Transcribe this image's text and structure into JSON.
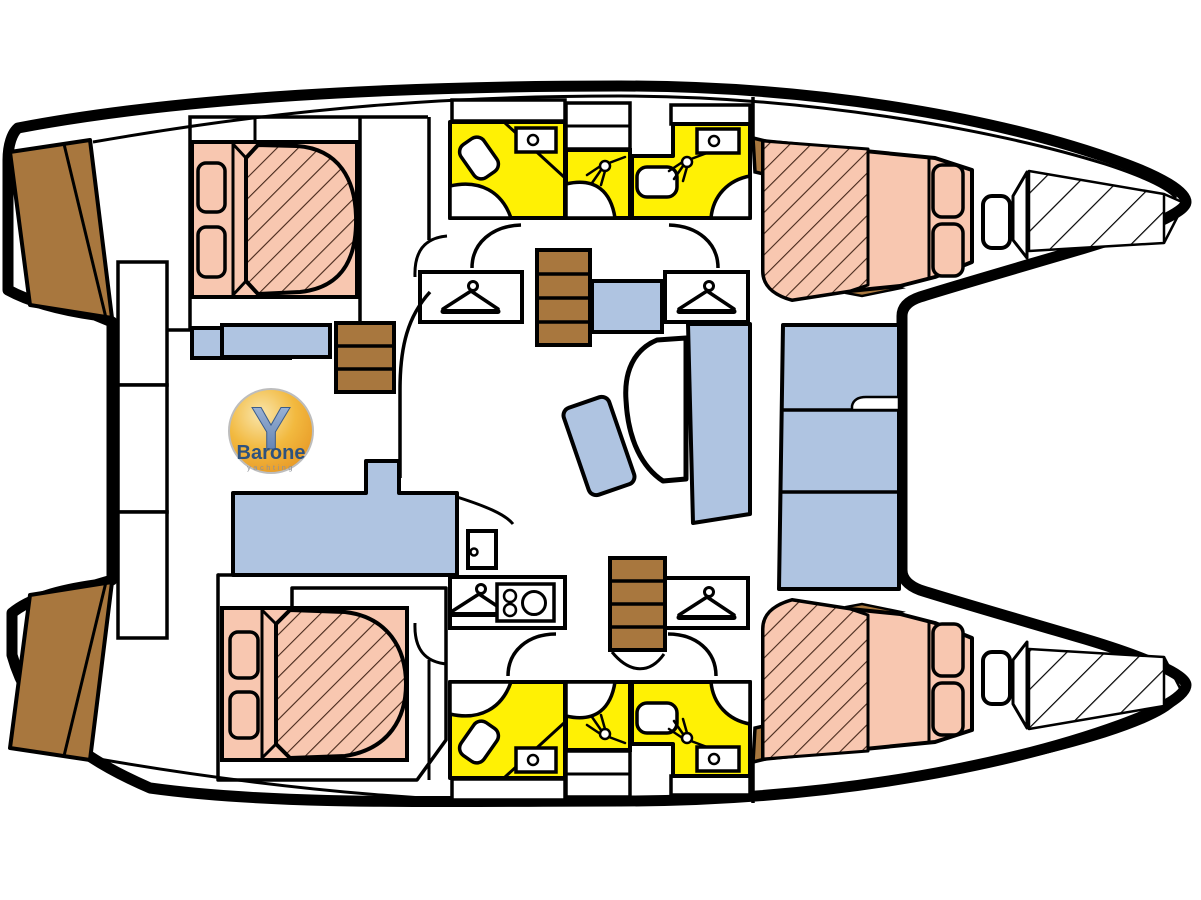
{
  "page": {
    "title": "Catamaran yacht layout plan (top view)",
    "background": "#ffffff"
  },
  "logo": {
    "letter": "Y",
    "name": "Barone",
    "subtitle": "yachting"
  },
  "colors": {
    "cabin_bed": "#F8C7B0",
    "wet_room": "#FFF104",
    "seating": "#AFC4E1",
    "wood_steps": "#A8773E",
    "outline": "#000000",
    "hatch_line": "#46281B",
    "logo_gold": "#F2B93F",
    "logo_blue": "#7E9CC8",
    "logo_text": "#2E527E"
  },
  "features": {
    "double_beds": 4,
    "wet_rooms_yellow": 6,
    "shower_heads": 4,
    "toilets": 4,
    "sinks": 6,
    "wardrobe_hangers": 4,
    "staircases": 4,
    "stove_burners": 3,
    "saloon_tables": 1,
    "bow_storage_compartments": 2
  }
}
